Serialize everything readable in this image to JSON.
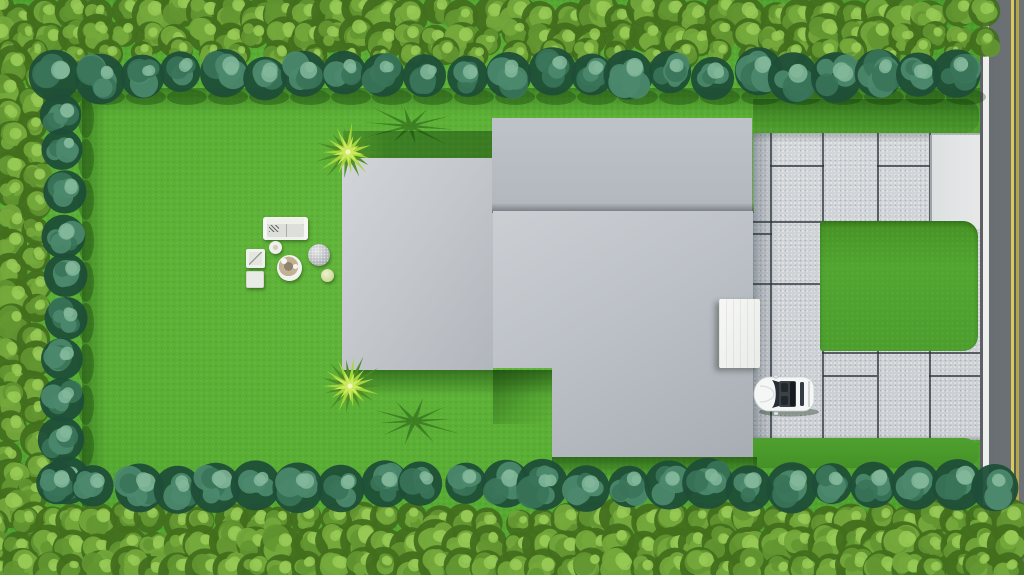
{
  "scene": {
    "description": "Aerial top-down 3D rendering of a residential lot: bright lawn bordered by a double hedge (outer yellow-green hedge and inner row of round teal trees), gray flat-roofed house volumes, a concrete paver driveway with inset lawn panels leading to a street with a double yellow center line, a parked white convertible, a white entry canopy, two palm trees with cast shadows, and a garden furniture set",
    "objects": [
      "lawn",
      "perimeter-hedge",
      "tree-row",
      "house-left-wing-roof",
      "house-upper-roof",
      "house-main-roof",
      "entry-canopy",
      "paver-driveway",
      "driveway-apron",
      "driveway-lawn-inset",
      "grass-strip",
      "street",
      "street-center-lines",
      "curb-line",
      "white-convertible-car",
      "palm-tree-1",
      "palm-tree-2",
      "palm-shadow-1",
      "palm-shadow-2",
      "garden-sofa",
      "ottoman",
      "armchair",
      "side-table",
      "dining-table",
      "stone-seat",
      "pouf"
    ]
  },
  "palette": {
    "lawn": "#58ad33",
    "lawn_light": "#64b73c",
    "lawn_dark": "#459127",
    "shadow_green": "#0f3a06",
    "hedge_light": "#97c955",
    "hedge_mid1": "#74a83c",
    "hedge_mid2": "#639631",
    "hedge_dark": "#436f1e",
    "tree_light": "#83b79a",
    "tree_mid1": "#4c8a6d",
    "tree_mid2": "#3a7459",
    "tree_dark": "#1f4e38",
    "roof_light": "#d1d5d9",
    "roof_mid": "#b8bdc3",
    "roof_dark": "#a8adb4",
    "paver": "#cfd3d6",
    "paver_joint": "#2a3238",
    "apron": "#e7e9e9",
    "canopy": "#f5f6f4",
    "road_asphalt": "#6d7276",
    "curb_white": "#ecefec",
    "line_yellow_bright": "#d9c85d",
    "line_yellow_dim": "#b2a646",
    "car_body": "#f5f7f7",
    "car_glass": "#262d34",
    "palm_bright": "#a6d63a",
    "palm_dark": "#4e8a24",
    "palm_pale": "#cdea62",
    "table_center_tan": "#c2b193"
  }
}
